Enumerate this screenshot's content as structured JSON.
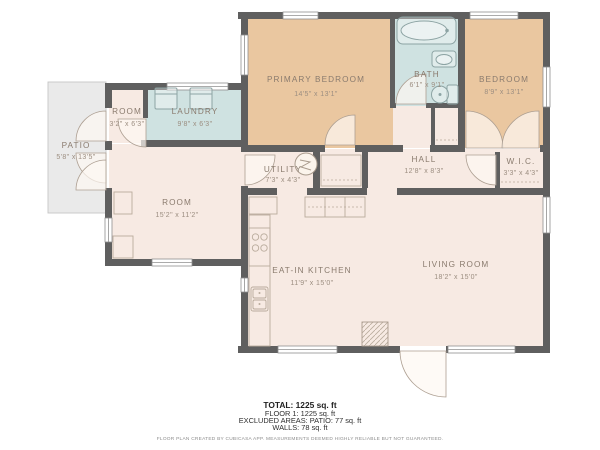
{
  "palette": {
    "wall": "#5f5f5f",
    "bedroom_fill": "#eac7a0",
    "wet_room_fill": "#cfe2e1",
    "room_fill": "#f7eae3",
    "patio_fill": "#eaeaea",
    "label_text": "#8a7b6e",
    "dims_text": "#9c8e81"
  },
  "rooms": {
    "primary_bedroom": {
      "label": "PRIMARY BEDROOM",
      "dims": "14'5\" x 13'1\""
    },
    "bath": {
      "label": "BATH",
      "dims": "6'1\" x 9'1\""
    },
    "bedroom": {
      "label": "BEDROOM",
      "dims": "8'9\" x 13'1\""
    },
    "room_small": {
      "label": "ROOM",
      "dims": "3'2\" x 6'3\""
    },
    "laundry": {
      "label": "LAUNDRY",
      "dims": "9'8\" x 6'3\""
    },
    "patio": {
      "label": "PATIO",
      "dims": "5'8\" x 13'5\""
    },
    "utility": {
      "label": "UTILITY",
      "dims": "7'3\" x 4'3\""
    },
    "hall": {
      "label": "HALL",
      "dims": "12'8\" x 8'3\""
    },
    "wic": {
      "label": "W.I.C.",
      "dims": "3'3\" x 4'3\""
    },
    "room_large": {
      "label": "ROOM",
      "dims": "15'2\" x 11'2\""
    },
    "kitchen": {
      "label": "EAT-IN KITCHEN",
      "dims": "11'9\" x 15'0\""
    },
    "living_room": {
      "label": "LIVING ROOM",
      "dims": "18'2\" x 15'0\""
    }
  },
  "summary": {
    "total": "TOTAL: 1225 sq. ft",
    "floor": "FLOOR 1: 1225 sq. ft",
    "excluded": "EXCLUDED AREAS: PATIO: 77 sq. ft",
    "walls": "WALLS: 78 sq. ft",
    "disclaimer": "FLOOR PLAN CREATED BY CUBICASA APP. MEASUREMENTS DEEMED HIGHLY RELIABLE BUT NOT GUARANTEED."
  }
}
